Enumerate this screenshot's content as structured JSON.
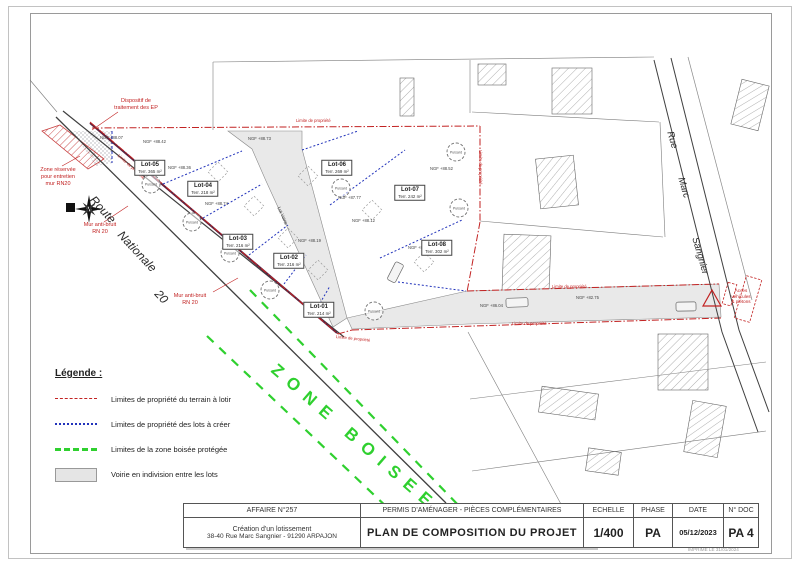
{
  "plan": {
    "lots": [
      {
        "name": "Lot-01",
        "area": "Terr. 214 m²"
      },
      {
        "name": "Lot-02",
        "area": "Terr. 216 m²"
      },
      {
        "name": "Lot-03",
        "area": "Terr. 216 m²"
      },
      {
        "name": "Lot-04",
        "area": "Terr. 218 m²"
      },
      {
        "name": "Lot-05",
        "area": "Terr. 365 m²"
      },
      {
        "name": "Lot-06",
        "area": "Terr. 269 m²"
      },
      {
        "name": "Lot-07",
        "area": "Terr. 242 m²"
      },
      {
        "name": "Lot-08",
        "area": "Terr. 302 m²"
      }
    ],
    "lot_voirie_label": "Lot Voirie",
    "puisard_label": "Puisard",
    "limite_label": "Limite de propriété",
    "ngf": [
      "NGF +88.07",
      "NGF +88.42",
      "NGF +88.73",
      "NGF +88.36",
      "NGF +88.74",
      "NGF +87.77",
      "NGF +88.52",
      "NGF +88.12",
      "NGF +86.04",
      "NGF +82.75",
      "NGF +88.19",
      "NGF +88.23"
    ],
    "streets": {
      "rn20": [
        "Route",
        "Nationale",
        "20"
      ],
      "rue": [
        "Rue",
        "Marc",
        "Sangnier"
      ]
    },
    "zone_boisee": "ZONE BOISEE",
    "annotations": {
      "dispositif": "Dispositif de\ntraitement des EP",
      "zone_reservee": "Zone réservée\npour entretien\nmur RN20",
      "mur_anti_bruit": "Mur anti-bruit\nRN 20",
      "acces": "Accès\nvéhicules\n& piétons"
    },
    "colors": {
      "red": "#c22222",
      "blue": "#2233bb",
      "green": "#2fd02f",
      "voirie_gray": "#e9e9e9",
      "maroon": "#5a2340"
    }
  },
  "legend": {
    "title": "Légende :",
    "items": [
      {
        "swatch": "red-dashdot-line",
        "label": "Limites de propriété du terrain à lotir"
      },
      {
        "swatch": "blue-dotted-line",
        "label": "Limites de propriété des lots à créer"
      },
      {
        "swatch": "green-dashed-line",
        "label": "Limites de la zone boisée protégée"
      },
      {
        "swatch": "gray-fill",
        "label": "Voirie en indivision entre les lots"
      }
    ]
  },
  "titleblock": {
    "affaire": "AFFAIRE N°257",
    "project_line1": "Création d'un lotissement",
    "project_line2": "38-40 Rue Marc Sangnier - 91290 ARPAJON",
    "doc_type": "PERMIS D'AMÉNAGER - PIÈCES COMPLÉMENTAIRES",
    "doc_title": "PLAN DE COMPOSITION DU PROJET",
    "echelle_label": "ECHELLE",
    "echelle_value": "1/400",
    "phase_label": "PHASE",
    "phase_value": "PA",
    "date_label": "DATE",
    "date_value": "05/12/2023",
    "ndoc_label": "N° DOC",
    "ndoc_value": "PA 4",
    "printed": "IMPRIMÉ LE 31/01/2024"
  }
}
